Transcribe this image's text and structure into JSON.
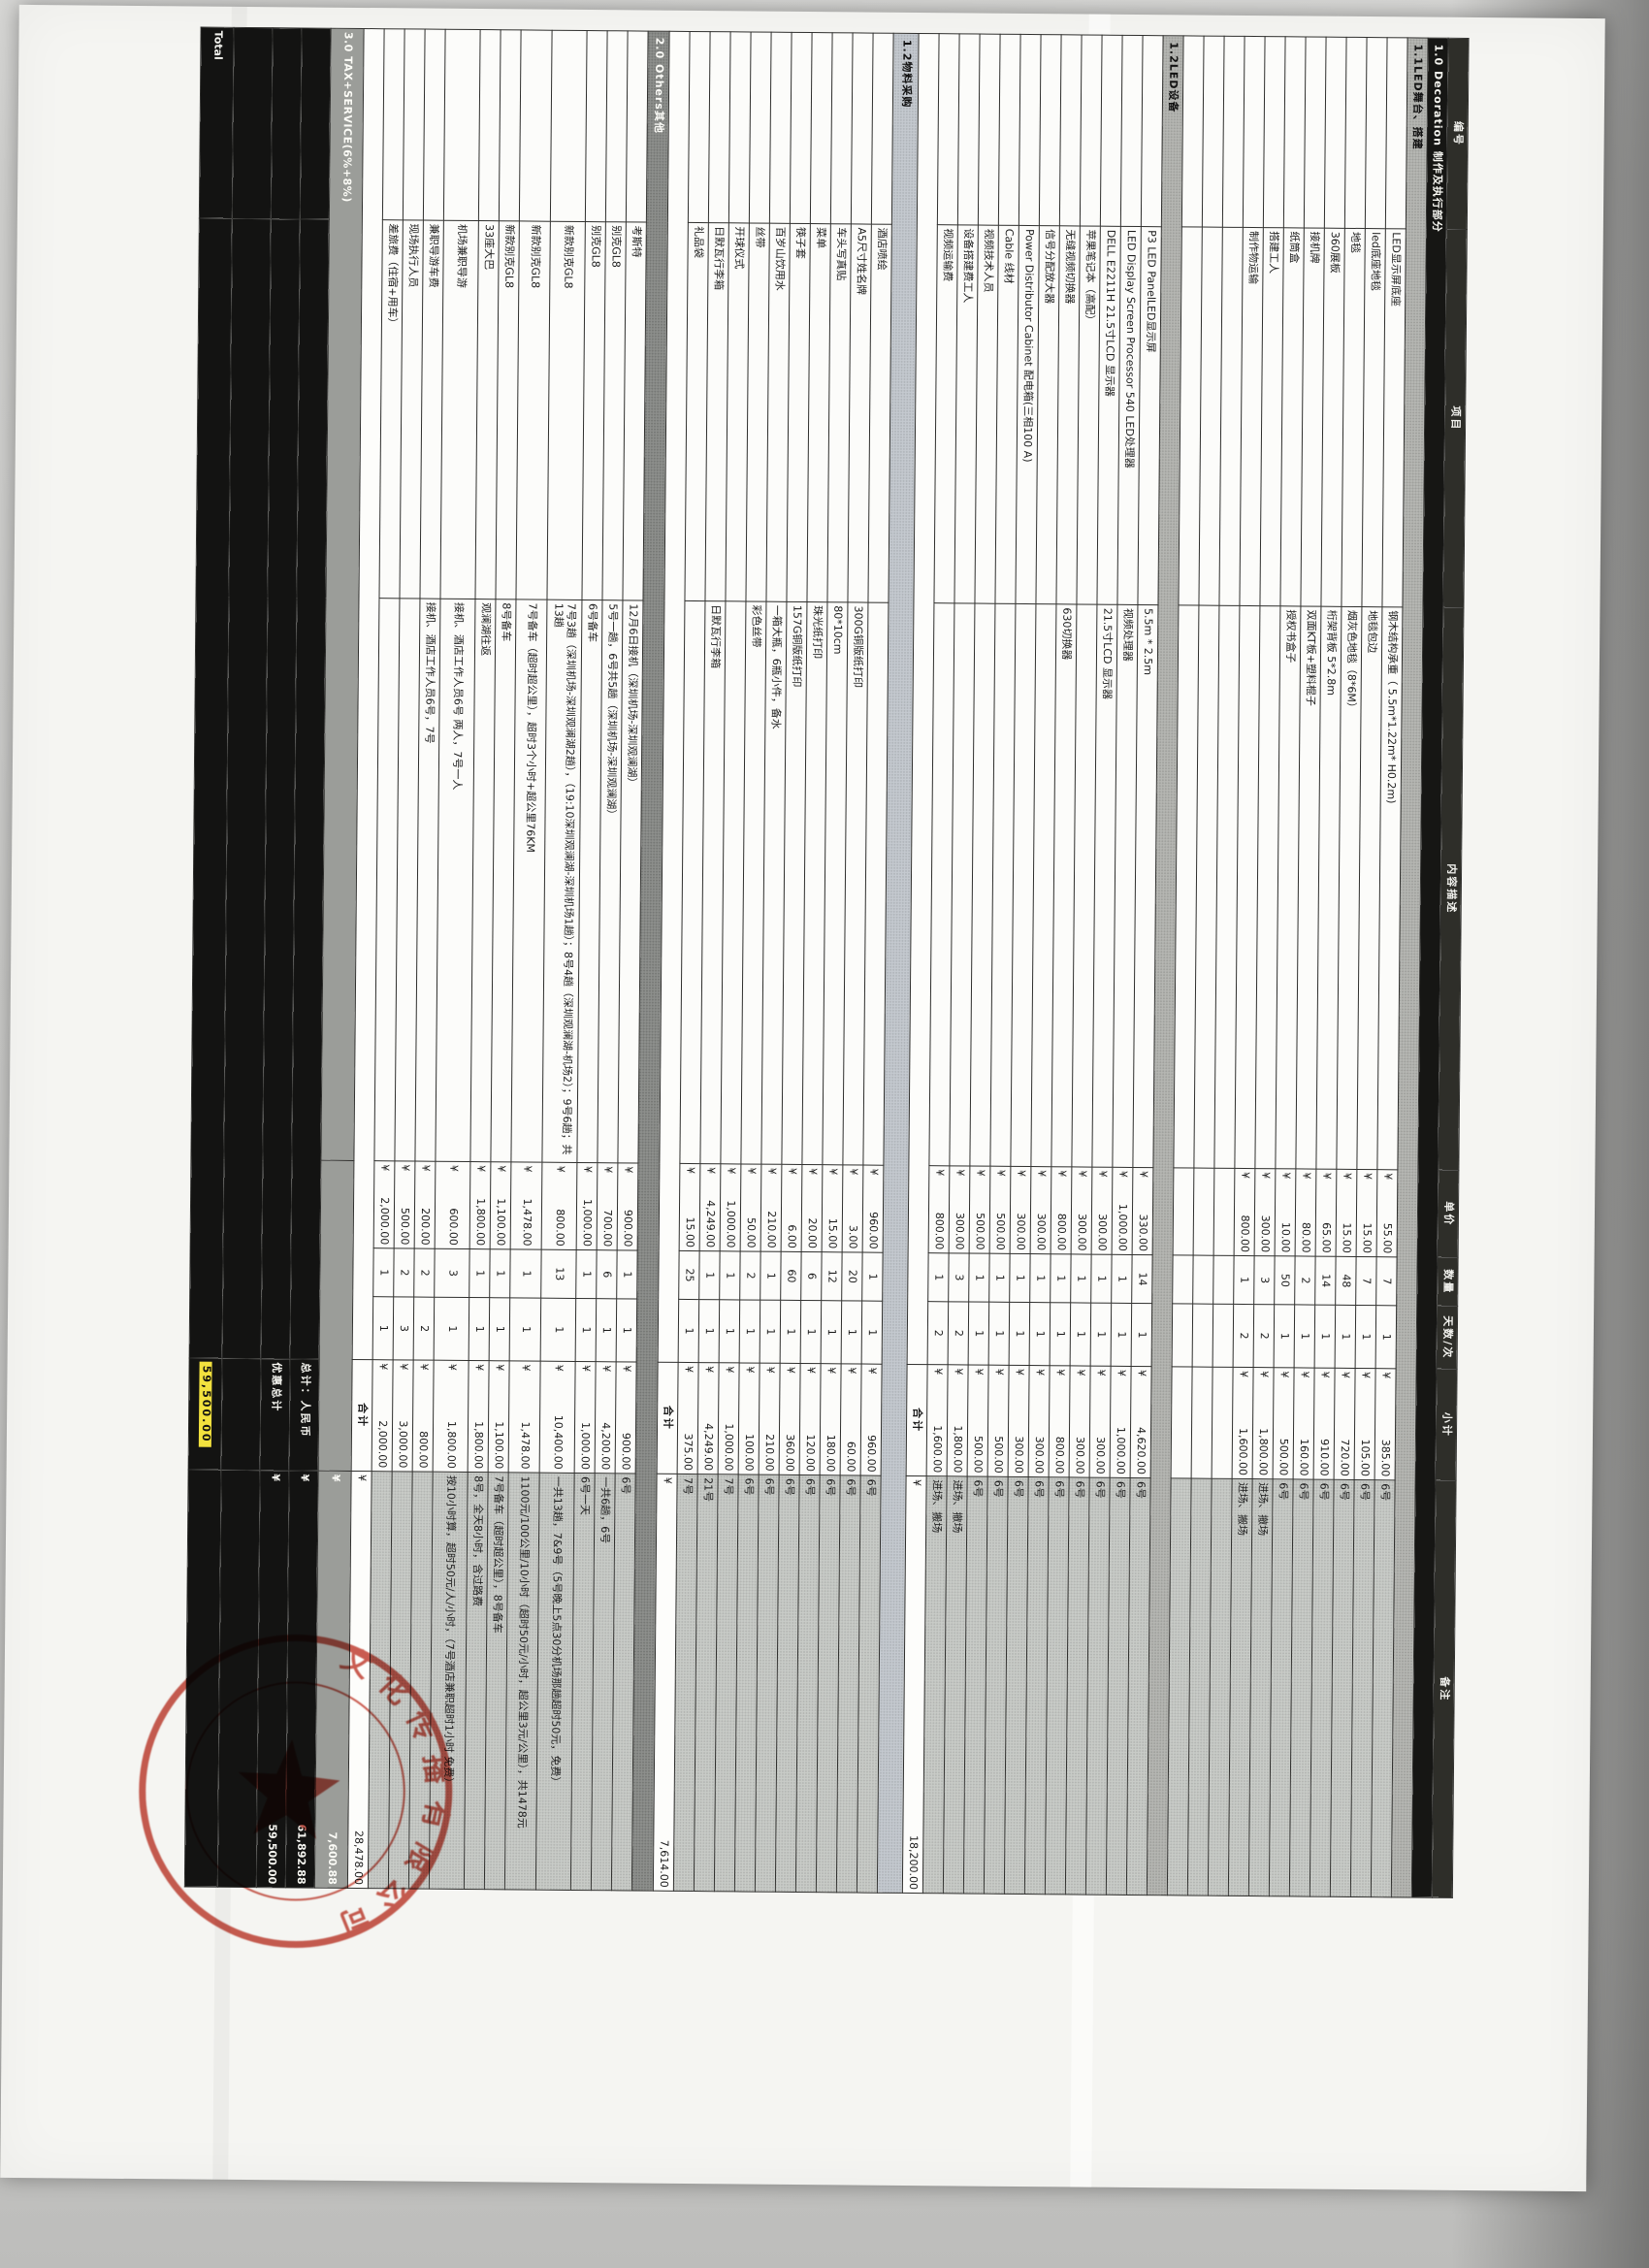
{
  "table": {
    "currency": "¥",
    "columns": [
      "编号",
      "项目",
      "内容描述",
      "单价",
      "数量",
      "天数/次",
      "小计",
      "备注"
    ],
    "rows": [
      {
        "type": "section",
        "style": "black",
        "label": "1.0 Decoration 制作及执行部分",
        "h": 20
      },
      {
        "type": "section",
        "style": "gray",
        "label": "1.1LED舞台、搭建",
        "h": 20
      },
      {
        "type": "item",
        "item": "LED显示屏底座",
        "desc": "钢木结构承重（ 5.5m*1.22m* H0.2m)",
        "price": "55.00",
        "qty": "7",
        "days": "1",
        "subtotal": "385.00",
        "note": "6号"
      },
      {
        "type": "item",
        "item": "led底座地毯",
        "desc": "地毯包边",
        "price": "15.00",
        "qty": "7",
        "days": "1",
        "subtotal": "105.00",
        "note": "6号"
      },
      {
        "type": "item",
        "item": "地毯",
        "desc": "烟灰色地毯（8*6M）",
        "price": "15.00",
        "qty": "48",
        "days": "1",
        "subtotal": "720.00",
        "note": "6号"
      },
      {
        "type": "item",
        "item": "360展板",
        "desc": "桁架背板 5*2.8m",
        "price": "65.00",
        "qty": "14",
        "days": "1",
        "subtotal": "910.00",
        "note": "6号"
      },
      {
        "type": "item",
        "item": "接机牌",
        "desc": "双面KT板+塑料棍子",
        "price": "80.00",
        "qty": "2",
        "days": "1",
        "subtotal": "160.00",
        "note": "6号"
      },
      {
        "type": "item",
        "item": "纸筒盒",
        "desc": "授权书盒子",
        "price": "10.00",
        "qty": "50",
        "days": "1",
        "subtotal": "500.00",
        "note": "6号"
      },
      {
        "type": "item",
        "item": "搭建工人",
        "desc": "",
        "price": "300.00",
        "qty": "3",
        "days": "2",
        "subtotal": "1,800.00",
        "note": "进场、撤场"
      },
      {
        "type": "item",
        "item": "制作物运输",
        "desc": "",
        "price": "800.00",
        "qty": "1",
        "days": "2",
        "subtotal": "1,600.00",
        "note": "进场、搬场"
      },
      {
        "type": "empty"
      },
      {
        "type": "empty"
      },
      {
        "type": "empty"
      },
      {
        "type": "section",
        "style": "gray",
        "label": "1.2LED设备",
        "h": 20
      },
      {
        "type": "item",
        "item": "P3 LED PanelLED显示屏",
        "desc": "5.5m * 2.5m",
        "price": "330.00",
        "qty": "14",
        "days": "1",
        "subtotal": "4,620.00",
        "note": "6号"
      },
      {
        "type": "item",
        "item": "LED Display Screen Processor 540 LED处理器",
        "desc": "视频处理器",
        "price": "1,000.00",
        "qty": "1",
        "days": "1",
        "subtotal": "1,000.00",
        "note": "6号"
      },
      {
        "type": "item",
        "item": "DELL E2211H 21.5寸LCD 显示器",
        "desc": "21.5寸LCD 显示器",
        "price": "300.00",
        "qty": "1",
        "days": "1",
        "subtotal": "300.00",
        "note": "6号"
      },
      {
        "type": "item",
        "item": "苹果笔记本（高配）",
        "desc": "",
        "price": "300.00",
        "qty": "1",
        "days": "1",
        "subtotal": "300.00",
        "note": "6号"
      },
      {
        "type": "item",
        "item": "无缝视频切换器",
        "desc": "630切换器",
        "price": "800.00",
        "qty": "1",
        "days": "1",
        "subtotal": "800.00",
        "note": "6号"
      },
      {
        "type": "item",
        "item": "信号分配放大器",
        "desc": "",
        "price": "300.00",
        "qty": "1",
        "days": "1",
        "subtotal": "300.00",
        "note": "6号"
      },
      {
        "type": "item",
        "item": "Power Distributor Cabinet 配电箱(三相100 A)",
        "desc": "",
        "price": "300.00",
        "qty": "1",
        "days": "1",
        "subtotal": "300.00",
        "note": "6号"
      },
      {
        "type": "item",
        "item": "Cable 线材",
        "desc": "",
        "price": "500.00",
        "qty": "1",
        "days": "1",
        "subtotal": "500.00",
        "note": "6号"
      },
      {
        "type": "item",
        "item": "视频技术人员",
        "desc": "",
        "price": "500.00",
        "qty": "1",
        "days": "1",
        "subtotal": "500.00",
        "note": "6号"
      },
      {
        "type": "item",
        "item": "设备搭建费工人",
        "desc": "",
        "price": "300.00",
        "qty": "3",
        "days": "2",
        "subtotal": "1,800.00",
        "note": "进场、撤场"
      },
      {
        "type": "item",
        "item": "视频运输费",
        "desc": "",
        "price": "800.00",
        "qty": "1",
        "days": "2",
        "subtotal": "1,600.00",
        "note": "进场、搬场"
      },
      {
        "type": "subtotal",
        "label": "合计",
        "amount": "18,200.00"
      },
      {
        "type": "section",
        "style": "light",
        "label": "1.2物料采购",
        "h": 26
      },
      {
        "type": "item",
        "item": "酒店喷绘",
        "desc": "",
        "price": "960.00",
        "qty": "1",
        "days": "1",
        "subtotal": "960.00",
        "note": "6号"
      },
      {
        "type": "item",
        "item": "A5尺寸姓名牌",
        "desc": "300G铜版纸打印",
        "price": "3.00",
        "qty": "20",
        "days": "1",
        "subtotal": "60.00",
        "note": "6号"
      },
      {
        "type": "item",
        "item": "车头写真贴",
        "desc": "80*10cm",
        "price": "15.00",
        "qty": "12",
        "days": "1",
        "subtotal": "180.00",
        "note": "6号"
      },
      {
        "type": "item",
        "item": "菜单",
        "desc": "珠光纸打印",
        "price": "20.00",
        "qty": "6",
        "days": "1",
        "subtotal": "120.00",
        "note": "6号"
      },
      {
        "type": "item",
        "item": "筷子套",
        "desc": "157G铜版纸打印",
        "price": "6.00",
        "qty": "60",
        "days": "1",
        "subtotal": "360.00",
        "note": "6号"
      },
      {
        "type": "item",
        "item": "百岁山饮用水",
        "desc": "一箱大瓶，6瓶小件，备水",
        "price": "210.00",
        "qty": "1",
        "days": "1",
        "subtotal": "210.00",
        "note": "6号"
      },
      {
        "type": "item",
        "item": "丝带",
        "desc": "彩色丝带",
        "price": "50.00",
        "qty": "2",
        "days": "1",
        "subtotal": "100.00",
        "note": "6号"
      },
      {
        "type": "item",
        "item": "开球仪式",
        "desc": "",
        "price": "1,000.00",
        "qty": "1",
        "days": "1",
        "subtotal": "1,000.00",
        "note": "7号"
      },
      {
        "type": "item",
        "item": "日默瓦行李箱",
        "desc": "日默瓦行李箱",
        "price": "4,249.00",
        "qty": "1",
        "days": "1",
        "subtotal": "4,249.00",
        "note": "21号"
      },
      {
        "type": "item",
        "item": "礼品袋",
        "desc": "",
        "price": "15.00",
        "qty": "25",
        "days": "1",
        "subtotal": "375.00",
        "note": "7号"
      },
      {
        "type": "subtotal",
        "label": "合计",
        "amount": "7,614.00"
      },
      {
        "type": "section",
        "style": "dark",
        "label": "2.0 Others其他",
        "h": 22
      },
      {
        "type": "item",
        "item": "考斯特",
        "desc": "12月6日接机（深圳机场-深圳观澜湖）",
        "price": "900.00",
        "qty": "1",
        "days": "1",
        "subtotal": "900.00",
        "note": "6号"
      },
      {
        "type": "item",
        "item": "别克GL8",
        "desc": "5号一趟，6号共5趟（深圳机场-深圳观澜湖）",
        "price": "700.00",
        "qty": "6",
        "days": "1",
        "subtotal": "4,200.00",
        "note": "一共6趟，6号"
      },
      {
        "type": "item",
        "item": "别克GL8",
        "desc": "6号备车",
        "price": "1,000.00",
        "qty": "1",
        "days": "1",
        "subtotal": "1,000.00",
        "note": "6号一天"
      },
      {
        "type": "item",
        "h": 36,
        "item": "新款别克GL8",
        "desc": "7号3趟（深圳机场-深圳观澜湖2趟），（19:10深圳观澜湖-深圳机场1趟）；8号4趟（深圳观澜湖-机场2）；9号6趟；共13趟",
        "price": "800.00",
        "qty": "13",
        "days": "1",
        "subtotal": "10,400.00",
        "note": "一共13趟，7&9号（5号晚上5点30分机场那趟超时50元，免费）"
      },
      {
        "type": "item",
        "h": 32,
        "item": "新款别克GL8",
        "desc": "7号备车（超时超公里），超时3个小时+超公里76KM",
        "price": "1,478.00",
        "qty": "1",
        "days": "1",
        "subtotal": "1,478.00",
        "note": "1100元/100公里/10小时（超时50元/小时，超公里3元/公里），共1478元"
      },
      {
        "type": "item",
        "item": "新款别克GL8",
        "desc": "8号备车",
        "price": "1,100.00",
        "qty": "1",
        "days": "1",
        "subtotal": "1,100.00",
        "note": "7号备车（超时超公里），8号备车"
      },
      {
        "type": "item",
        "item": "33座大巴",
        "desc": "观澜湖往返",
        "price": "1,800.00",
        "qty": "1",
        "days": "1",
        "subtotal": "1,800.00",
        "note": "8号，全天8小时，含过路费"
      },
      {
        "type": "item",
        "h": 36,
        "item": "机场兼职导游",
        "desc": "接机、酒店工作人员6号 两人，7号一人",
        "price": "600.00",
        "qty": "3",
        "days": "1",
        "subtotal": "1,800.00",
        "note": "按10小时算，超时50元/人/小时，（7号酒店兼职超时1小时 免费）"
      },
      {
        "type": "item",
        "item": "兼职导游车费",
        "desc": "接机、酒店工作人员6号，7号",
        "price": "200.00",
        "qty": "2",
        "days": "2",
        "subtotal": "800.00",
        "note": ""
      },
      {
        "type": "item",
        "item": "现场执行人员",
        "desc": "",
        "price": "500.00",
        "qty": "2",
        "days": "3",
        "subtotal": "3,000.00",
        "note": ""
      },
      {
        "type": "item",
        "item": "差旅费（住宿+用车）",
        "desc": "",
        "price": "2,000.00",
        "qty": "1",
        "days": "1",
        "subtotal": "2,000.00",
        "note": ""
      },
      {
        "type": "subtotal",
        "label": "合计",
        "amount": "28,478.00"
      },
      {
        "type": "tax",
        "label": "3.0 TAX+SERVICE(6%+8%)",
        "amount": "7,600.88",
        "h": 34
      },
      {
        "type": "total",
        "corner": "",
        "label": "总计：人民币",
        "amount": "61,892.88",
        "h": 30
      },
      {
        "type": "total",
        "corner": "",
        "label": "优惠总计",
        "amount": "59,500.00",
        "h": 30
      },
      {
        "type": "total",
        "corner": "",
        "label": "",
        "amount": "",
        "h": 40
      },
      {
        "type": "total",
        "corner": "Total",
        "label": "",
        "amount": "",
        "highlight": "59,500.00",
        "h": 34
      }
    ]
  },
  "stamp": {
    "arc_text": "文化传播有限公司",
    "color": "#c0392b"
  }
}
